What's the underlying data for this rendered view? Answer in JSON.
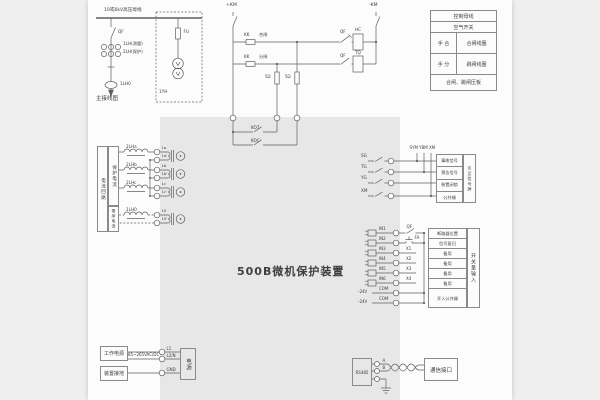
{
  "title": "500B微机保护装置",
  "single_line": {
    "busbar": "10或6kV高压母线",
    "qf": "QF",
    "ct_measure": "1LH(测量)",
    "ct_protect": "2LH(保护)",
    "zero_ct": "1LH0",
    "caption": "主接线图",
    "fuse": "FU",
    "pt": "1YH"
  },
  "control_panel": {
    "row1": "控制母线",
    "row2": "空气开关",
    "close_left": "手 合",
    "close_right": "合闸线圈",
    "trip_left": "手 分",
    "trip_right": "跳闸线圈",
    "footer": "合闸、跳闸压板"
  },
  "control_circuit": {
    "pos": "+KM",
    "neg": "-KM",
    "kk1": "KK",
    "close": "合闸",
    "kk2": "KK",
    "trip": "分闸",
    "qf_top": "QF",
    "qf_bottom": "QF",
    "hc": "HC",
    "tq": "TQ",
    "r1": "5Ω",
    "r2": "5Ω",
    "kot": "KOT",
    "koc": "KOC"
  },
  "current_inputs": {
    "group": "电流回路",
    "protect": "保护电流",
    "zero": "零序电流",
    "cts": [
      "2LHa",
      "2LHb",
      "2LHc",
      "1LH0"
    ],
    "terminals": [
      [
        "1a",
        "1a'"
      ],
      [
        "1b",
        "1b'"
      ],
      [
        "1c",
        "1c'"
      ],
      [
        "10",
        "10'"
      ]
    ]
  },
  "power": {
    "box1": "工作电源",
    "box2": "装置接地",
    "range": "85~265VAC/DC",
    "t1": "L1",
    "t2": "L2/N",
    "t3": "GND",
    "module": "电源"
  },
  "signal": {
    "contacts": [
      "SG",
      "TG",
      "YG",
      "XM"
    ],
    "buses": [
      "SYM",
      "YBM",
      "XM"
    ],
    "rows": [
      "事故信号",
      "预告信号",
      "装置闭锁",
      "公共端"
    ],
    "side": "引至信号屏"
  },
  "inputs": {
    "wires": [
      "IN1",
      "IN2",
      "IN3",
      "IN4",
      "IN5",
      "IN6",
      "COM",
      "COM"
    ],
    "minus24": "-24V",
    "qf": "QF",
    "fa": "FA",
    "spares": [
      "X1",
      "X2",
      "X3",
      "X4"
    ],
    "rows": [
      "断路器位置",
      "信号复归",
      "备用",
      "备用",
      "备用",
      "备用",
      "开入公共端"
    ],
    "side": "开关量输入"
  },
  "comm": {
    "module": "RS485",
    "a": "A",
    "b": "B",
    "box": "通信接口"
  }
}
